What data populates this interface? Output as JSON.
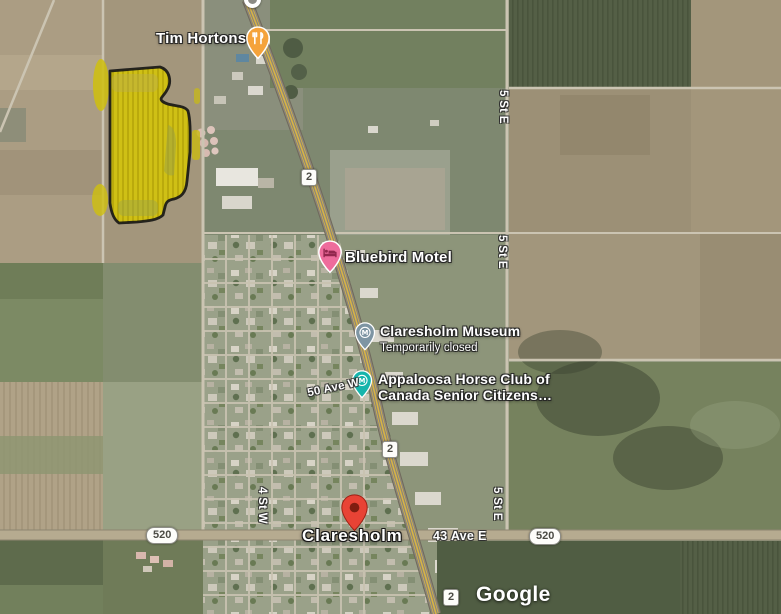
{
  "map": {
    "provider_logo": "Google",
    "place_label": "Claresholm",
    "place_pin_color": "#E84335",
    "pois": [
      {
        "name": "Tim Hortons",
        "icon": "restaurant-pin",
        "pin_color": "#F5A33B"
      },
      {
        "name": "Bluebird Motel",
        "icon": "lodging-pin",
        "pin_color": "#EE6C9C"
      },
      {
        "name": "Claresholm Museum",
        "status": "Temporarily closed",
        "icon": "museum-pin",
        "pin_color": "#7E95A3"
      },
      {
        "name": "Appaloosa Horse Club of Canada Senior Citizens…",
        "lines": [
          "Appaloosa Horse Club of",
          "Canada Senior Citizens…"
        ],
        "icon": "museum-pin",
        "pin_color": "#16B5AC"
      }
    ],
    "road_labels": [
      "5 St E",
      "5 St E",
      "5 St E",
      "4 St W",
      "50 Ave W",
      "43 Ave E"
    ],
    "route_shields": [
      "2",
      "2",
      "2",
      "520",
      "520"
    ],
    "highlight": {
      "fill": "#D5C60B",
      "outline": "#151515"
    }
  }
}
